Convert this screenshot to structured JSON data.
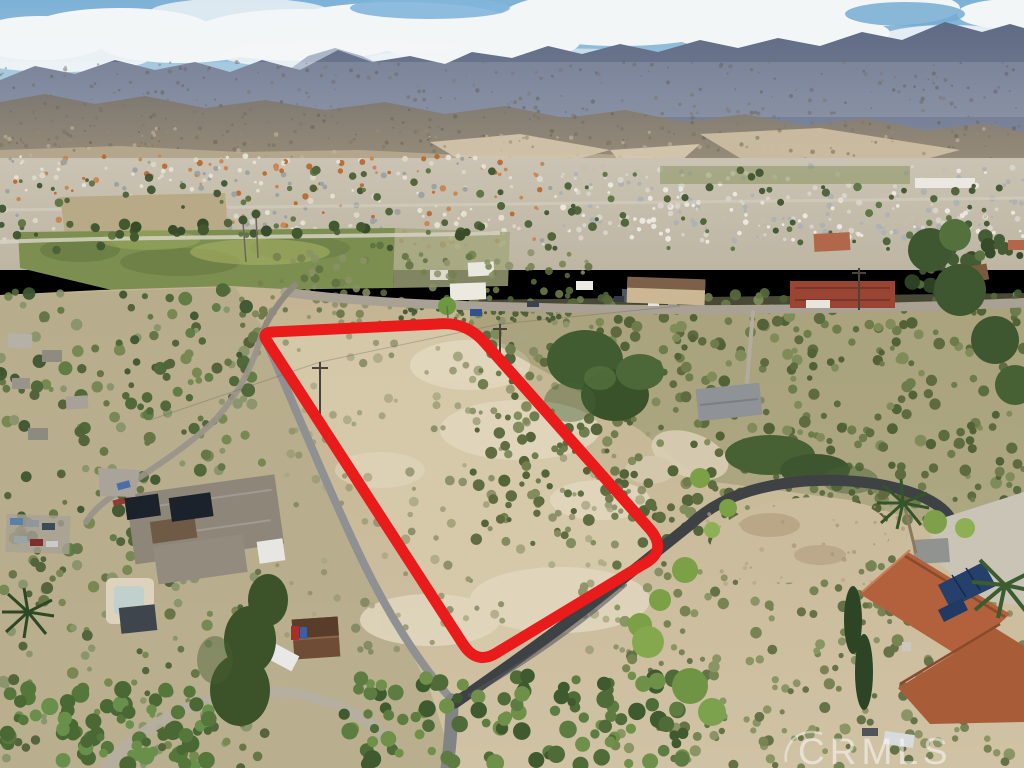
{
  "scene": {
    "kind": "aerial-drone-photo",
    "subject": "vacant hillside land parcel outlined in red, suburban valley and mountain range behind"
  },
  "watermark": {
    "text": "CRMLS",
    "color": "#ffffff",
    "opacity": 0.52
  },
  "parcel": {
    "path": "M 272 332 L 438 324 Q 466 321 485 343 L 648 527 Q 670 551 642 565 L 498 652 Q 477 666 463 644 L 267 341 Q 261 333 272 332 Z",
    "color": "#ea1b1b",
    "stroke_width": 11
  },
  "palette": {
    "sky_top": "#7db1d6",
    "sky_horizon": "#c9dce6",
    "cloud": "#f3f6f7",
    "mountain_far": "#5f6a84",
    "mountain_haze": "#9dabbf",
    "mountain_mid": "#857e74",
    "foothill": "#b3a68c",
    "cliff": "#d5c7ac",
    "valley": "#c6bfae",
    "field_green": "#7c8f51",
    "field_dirt": "#b8a987",
    "hillside": "#c6b795",
    "parcel_dirt": "#d6c9aa",
    "scrub_olive": "#6b7a4a",
    "road_asphalt": "#3e4245",
    "road_gray": "#8e9092",
    "road_light": "#b5ae9f",
    "road_brow": "#a8a194",
    "dirt_pad": "#cbbc9d",
    "concrete": "#c9c4b6",
    "roof_terracotta": "#b2613c",
    "roof_red": "#9a4434",
    "roof_gray": "#8e8679",
    "roof_cabin": "#6e4c36",
    "solar_panel": "#1c222c",
    "solar_panel_blue": "#24406b",
    "tree_dark": "#415c31",
    "tree_bright": "#7da24e",
    "pool_deck": "#ddd3bd"
  },
  "texture": {
    "layers": [
      {
        "name": "mtn-streaks",
        "seed": 11,
        "region": [
          0,
          62,
          1024,
          148
        ],
        "count": 380,
        "rmin": 0.8,
        "rmax": 2.2,
        "colors": [
          "#6c675e",
          "#5e5a52",
          "#7a7468"
        ],
        "opacity": 0.45
      },
      {
        "name": "foothill-specks",
        "seed": 12,
        "region": [
          0,
          128,
          1024,
          174
        ],
        "count": 160,
        "rmin": 0.8,
        "rmax": 2.4,
        "colors": [
          "#998b72",
          "#c6b79c",
          "#7d725d"
        ],
        "opacity": 0.6
      },
      {
        "name": "valley-specks-left",
        "seed": 13,
        "region": [
          0,
          156,
          560,
          248
        ],
        "count": 300,
        "rmin": 1.2,
        "rmax": 3.2,
        "colors": [
          "#c8834f",
          "#e8e3d6",
          "#9aa0a2",
          "#b9672f",
          "#ded8c8"
        ],
        "opacity": 0.92
      },
      {
        "name": "valley-specks-right",
        "seed": 14,
        "region": [
          560,
          166,
          1024,
          242
        ],
        "count": 270,
        "rmin": 1.2,
        "rmax": 3.2,
        "colors": [
          "#eceae2",
          "#d8d5cc",
          "#aeb2b4",
          "#c4bfae"
        ],
        "opacity": 0.95
      },
      {
        "name": "valley-trees",
        "seed": 15,
        "region": [
          0,
          170,
          1024,
          250
        ],
        "count": 120,
        "rmin": 1.8,
        "rmax": 4.5,
        "colors": [
          "#4c6137",
          "#5d7442",
          "#3f5530"
        ],
        "opacity": 0.95
      },
      {
        "name": "treerow",
        "seed": 16,
        "region": [
          50,
          224,
          500,
          238
        ],
        "count": 18,
        "rmin": 3.5,
        "rmax": 6,
        "colors": [
          "#42582f",
          "#374d28"
        ],
        "opacity": 1
      },
      {
        "name": "scrub-mid-band",
        "seed": 17,
        "region": [
          255,
          252,
          600,
          328
        ],
        "count": 110,
        "rmin": 2,
        "rmax": 4.5,
        "colors": [
          "#75814f",
          "#5f7040",
          "#8b9168"
        ],
        "opacity": 0.85
      },
      {
        "name": "scrub-left",
        "seed": 18,
        "region": [
          0,
          288,
          265,
          768
        ],
        "count": 240,
        "rmin": 2.5,
        "rmax": 6,
        "colors": [
          "#5e7040",
          "#72844c",
          "#4a5c34",
          "#86936a"
        ],
        "opacity": 0.9
      },
      {
        "name": "left-yard-trees",
        "seed": 19,
        "region": [
          0,
          290,
          255,
          560
        ],
        "count": 70,
        "rmin": 3,
        "rmax": 7,
        "colors": [
          "#4c6636",
          "#5d7a42",
          "#3d5630"
        ],
        "opacity": 0.95
      },
      {
        "name": "scrub-parcel",
        "seed": 20,
        "region": [
          270,
          335,
          660,
          655
        ],
        "count": 170,
        "rmin": 2,
        "rmax": 5,
        "colors": [
          "#8c8f68",
          "#9a9b74",
          "#7b835c",
          "#a9a682"
        ],
        "opacity": 0.8
      },
      {
        "name": "scrub-right-dense",
        "seed": 21,
        "region": [
          470,
          292,
          1024,
          545
        ],
        "count": 480,
        "rmin": 2.5,
        "rmax": 6,
        "colors": [
          "#6b7a4a",
          "#59683c",
          "#7d8a58",
          "#4e5f34"
        ],
        "opacity": 0.95
      },
      {
        "name": "scrub-bottom-right",
        "seed": 22,
        "region": [
          615,
          555,
          1024,
          768
        ],
        "count": 230,
        "rmin": 2.5,
        "rmax": 6,
        "colors": [
          "#6f7d4c",
          "#5a6a3e",
          "#83905e"
        ],
        "opacity": 0.9
      },
      {
        "name": "rightedge-trees",
        "seed": 27,
        "region": [
          895,
          235,
          1024,
          300
        ],
        "count": 40,
        "rmin": 3,
        "rmax": 8,
        "colors": [
          "#3f5730",
          "#54713d",
          "#2f4526"
        ],
        "opacity": 0.95
      },
      {
        "name": "pad-pebbles",
        "seed": 23,
        "region": [
          705,
          505,
          945,
          585
        ],
        "count": 45,
        "rmin": 1,
        "rmax": 2.5,
        "colors": [
          "#b7a687",
          "#a7967a"
        ],
        "opacity": 0.7
      },
      {
        "name": "rowcrop",
        "seed": 24,
        "region": [
          390,
          304,
          560,
          322
        ],
        "count": 45,
        "rmin": 1.5,
        "rmax": 3,
        "colors": [
          "#3f5530",
          "#4c6339"
        ],
        "opacity": 0.9
      },
      {
        "name": "bottom-trees",
        "seed": 25,
        "region": [
          340,
          675,
          690,
          768
        ],
        "count": 110,
        "rmin": 4,
        "rmax": 9,
        "colors": [
          "#3f5a2e",
          "#4e6b38",
          "#5d7c42",
          "#6f9048"
        ],
        "opacity": 1
      },
      {
        "name": "bottom-left-trees",
        "seed": 26,
        "region": [
          0,
          688,
          210,
          768
        ],
        "count": 80,
        "rmin": 4,
        "rmax": 9,
        "colors": [
          "#55773c",
          "#68904a",
          "#4a6834"
        ],
        "opacity": 1
      }
    ]
  }
}
